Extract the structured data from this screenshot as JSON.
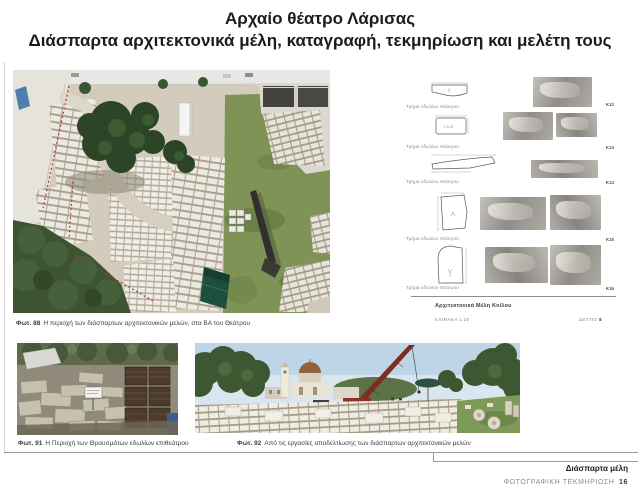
{
  "title": {
    "line1": "Αρχαίο θέατρο Λάρισας",
    "line2": "Διάσπαρτα αρχιτεκτονικά μέλη, καταγραφή, τεκμηρίωση και μελέτη τους"
  },
  "photos": {
    "main": {
      "label": "Φωτ. 88",
      "caption": "Η περιοχή των διάσπαρτων αρχιτεκτονικών μελών, στα ΒΑ του Θεάτρου"
    },
    "bottom_left": {
      "label": "Φωτ. 91",
      "caption": "Η Περιοχή των Θραυσμάτων εδωλίων επιθεάτρου"
    },
    "bottom_right": {
      "label": "Φωτ. 92",
      "caption": "Από τις εργασίες αποδελτίωσης των διάσπαρτων αρχιτεκτονικών μελών"
    }
  },
  "catalog": {
    "entries": [
      {
        "caption": "Τμήμα εδωλίου Θεάτρου",
        "code": "Κ12"
      },
      {
        "caption": "Τμήμα εδωλίου Θεάτρου",
        "code": "Κ13"
      },
      {
        "caption": "Τμήμα εδωλίου Θεάτρου",
        "code": "Κ14"
      },
      {
        "caption": "Τμήμα εδωλίου Θεάτρου",
        "code": "Κ15"
      },
      {
        "caption": "Τμήμα εδωλίου Θεάτρου",
        "code": "Κ16"
      }
    ],
    "footer_title": "Αρχιτεκτονικά Μέλη Κοίλου",
    "scale": "ΚΛΙΜΑΚΑ 1:20",
    "sheet_label": "ΔΕΛΤΙΟ",
    "sheet_no": "8"
  },
  "footer": {
    "section": "Διάσπαρτα μέλη",
    "doc_label": "ΦΩΤΟΓΡΑΦΙΚΗ ΤΕΚΜΗΡΙΩΣΗ",
    "page": "16"
  },
  "colors": {
    "accent_green": "#1f4f3c",
    "grass": "#7e9355",
    "crane_red": "#8a3228"
  }
}
